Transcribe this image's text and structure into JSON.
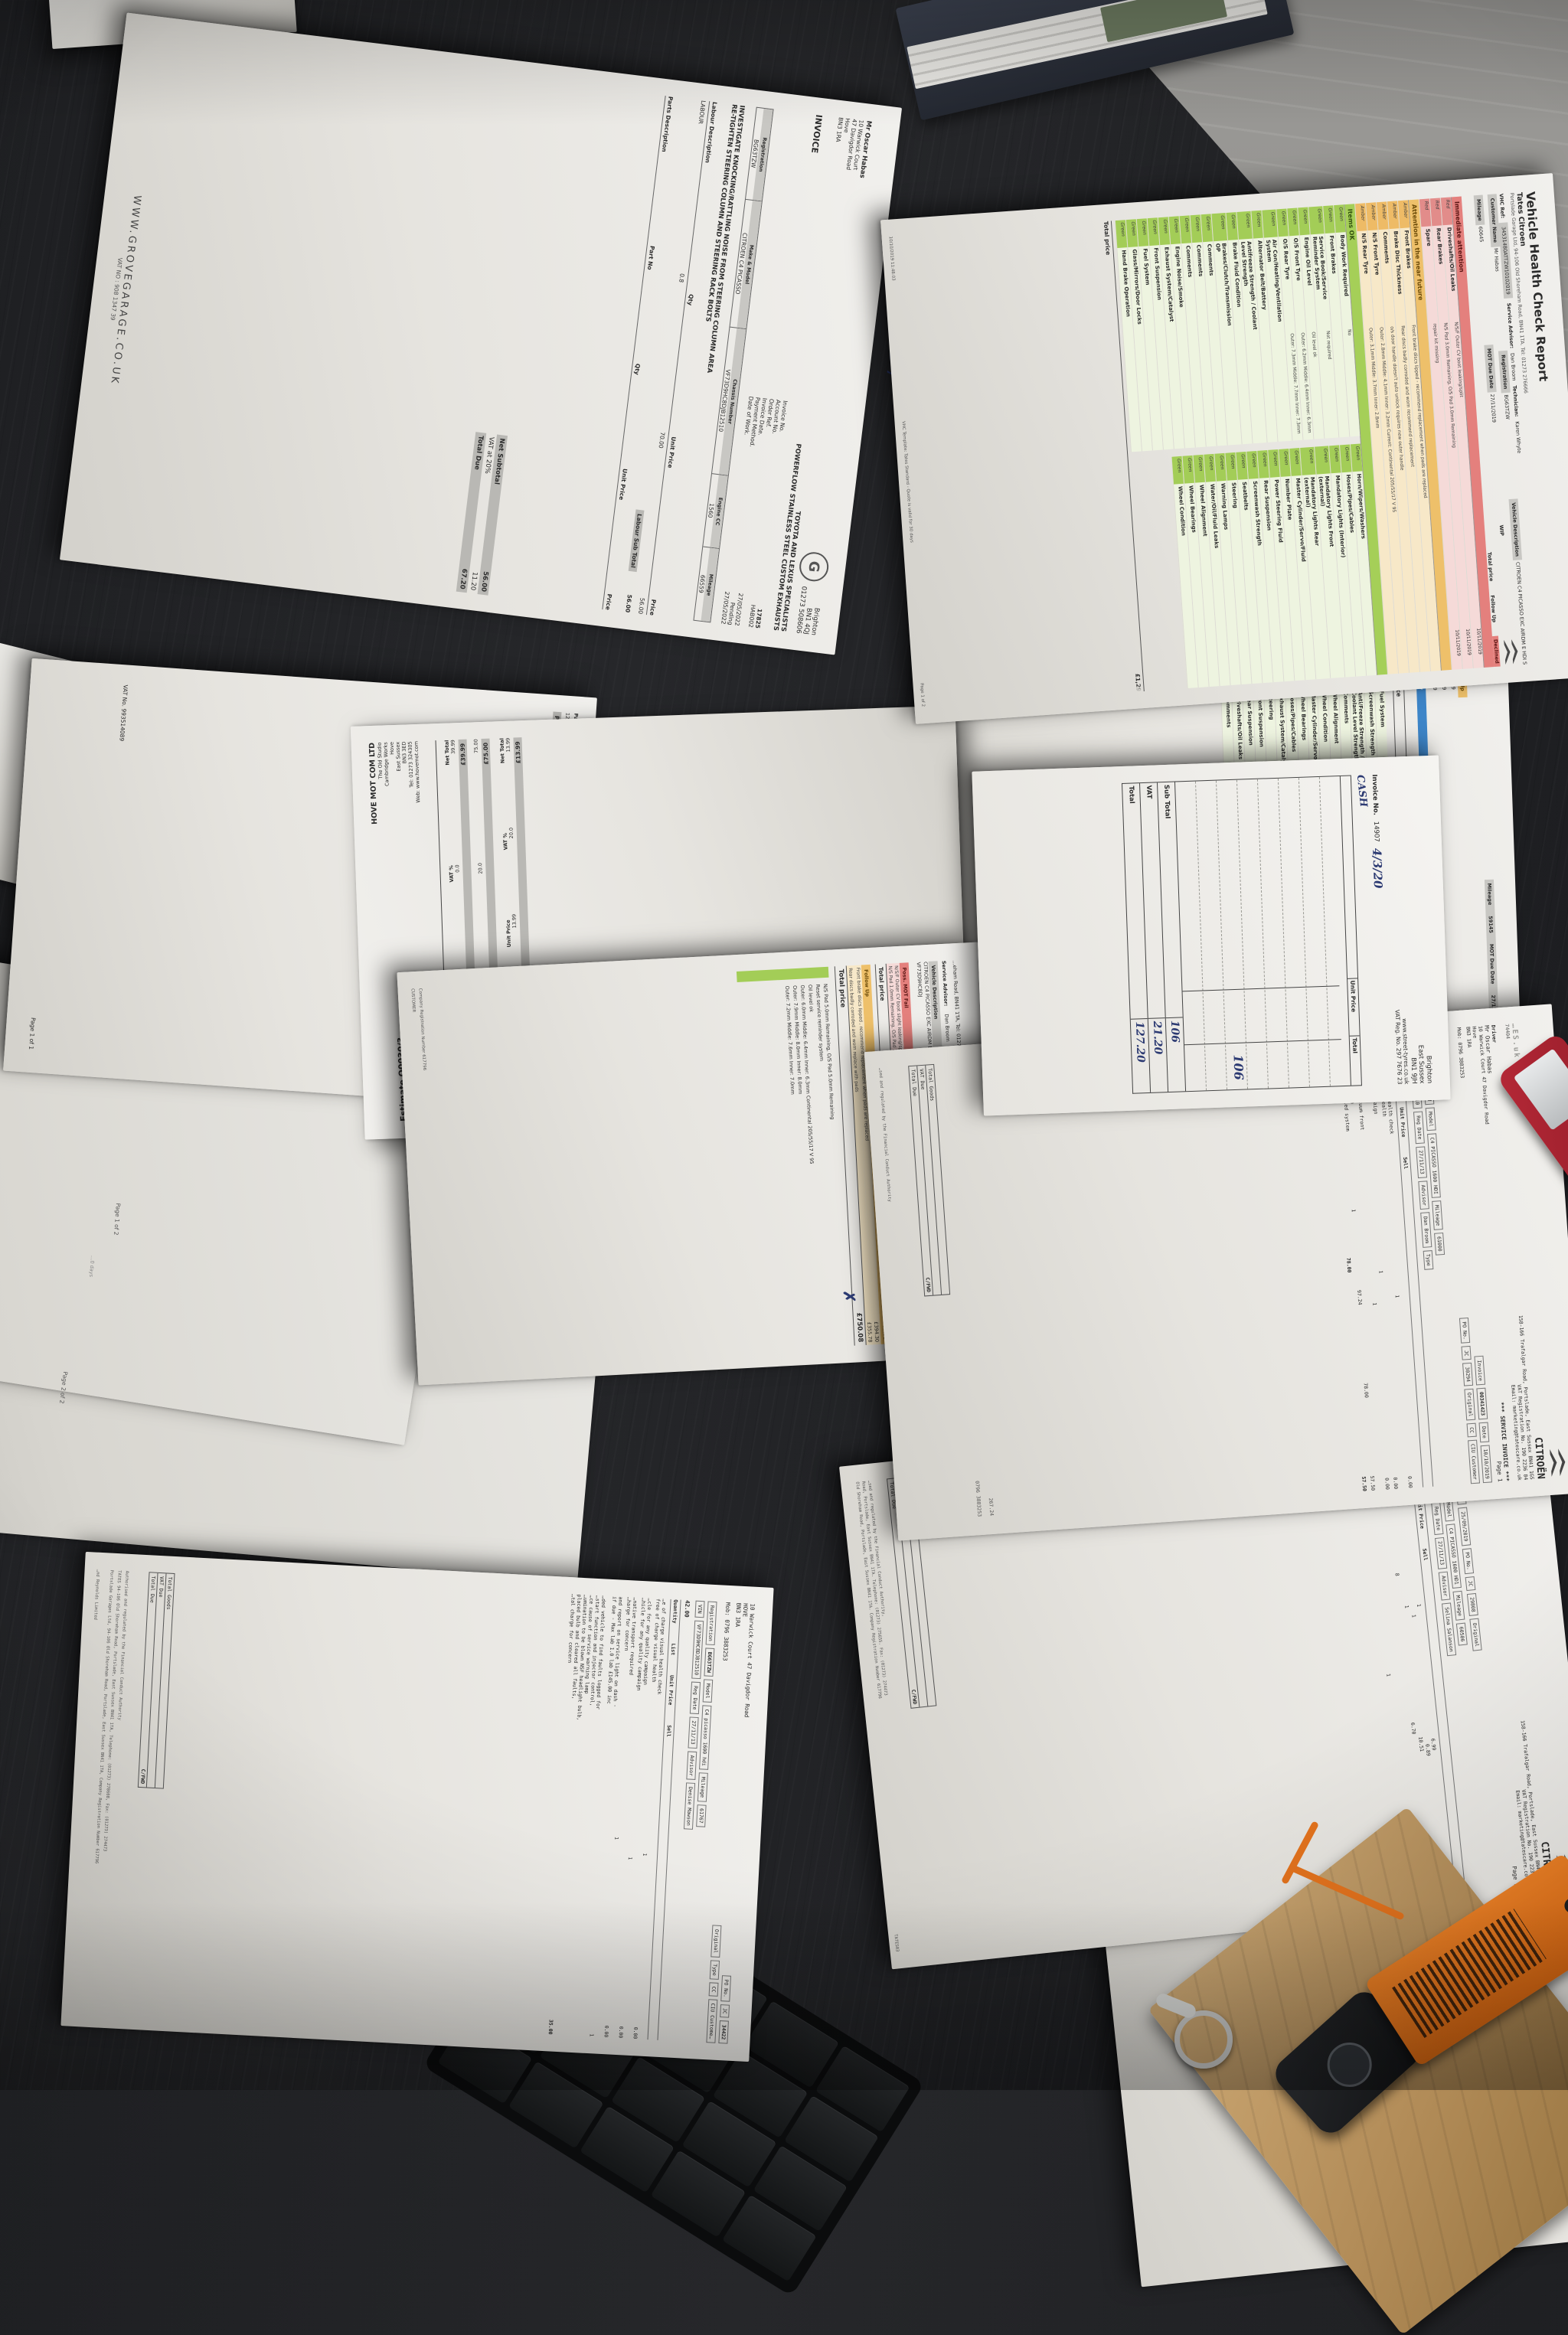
{
  "labels": {
    "red": "Red",
    "amber": "Amber",
    "green": "Green"
  },
  "misc": {
    "page1of2": "Page 1 of 2",
    "page2of2": "Page 2 of 2",
    "days": "…0 days",
    "hand_g": "G ⁊",
    "corner": "74404",
    "reynolds": "…nd Reynolds Limited"
  },
  "vhc1": {
    "title": "Vehicle Health Check Report",
    "dealer": "Tates Citroen",
    "dealer_address": "Portslade Garage Ltd, 94-106 Old Shoreham Road, BN41 1TA. Tel: 01273 276666",
    "vhc_ref_label": "VHC Ref:",
    "vhc_ref": "34531480ATTZW10102019",
    "customer_label": "Customer Name",
    "customer": "Mr Habas",
    "reg_label": "Registration",
    "reg": "BG63TZW",
    "advisor_label": "Service Advisor:",
    "advisor": "Dan Broom",
    "tech_label": "Technician:",
    "tech": "Karen Whyte",
    "vdesc_label": "Vehicle Description",
    "vdesc": "CITROEN C4 PICASSO EXC AIRDM E HDI S",
    "mileage_label": "Mileage",
    "mileage": "60645",
    "mot_label": "MOT Due Date",
    "mot": "27/11/2019",
    "wip": "WIP",
    "col_total": "Total price",
    "col_follow": "Follow Up",
    "col_declined": "Declined",
    "sec_red": "Immediate attention",
    "red_rows": [
      {
        "item": "Driveshafts/Oil Leaks",
        "note": "N/S/F Outer CV boot leaking/split",
        "date": "10/11/2019"
      },
      {
        "item": "Rear Brakes",
        "note": "N/S Pad 3.0mm Remaining, O/S Pad 3.0mm Remaining",
        "date": "10/11/2019"
      },
      {
        "item": "Spare",
        "note": "repair kit missing",
        "date": "10/11/2019"
      }
    ],
    "sec_amber": "Attention in the near future",
    "amber_rows": [
      {
        "item": "Front Brakes",
        "note": "Front brake discs lipped - recommend replacement when pads are replaced"
      },
      {
        "item": "Brake Disc Thickness",
        "note": "Rear discs badly corroded and worn recommend replacement"
      },
      {
        "item": "Comments",
        "note": "o/s door handle doesn't auto unlock requires new outer handle"
      },
      {
        "item": "N/S Front Tyre",
        "note": "Outer: 2.8mm Middle: 4.1mm Inner: 3.2mm  Current: Continental 205/55/17 V 95"
      },
      {
        "item": "N/S Rear Tyre",
        "note": "Outer: 3.1mm Middle: 3.7mm Inner: 2.8mm"
      }
    ],
    "sec_green": "Items OK",
    "green1": [
      "Body Work Required",
      "Front Brakes",
      "Service Book/Service Reminder System",
      "Engine Oil Level",
      "O/S Front Tyre",
      "O/S Rear Tyre",
      "Air Con/Heating/Ventilation System",
      "Alternator Belt/Battery",
      "Antifreeze Strength / Coolant Level Strength",
      "Brake Fluid Condition",
      "Brakes/Clutch/Transmission OP",
      "Comments",
      "Comments",
      "Comments",
      "Engine Noise/Smoke",
      "Exhaust System/Catalyst",
      "Front Suspension",
      "Fuel System",
      "Glass/Mirrors/Door Locks",
      "Hand Brake Operation"
    ],
    "green1n": [
      "No",
      "",
      "Not required",
      "Oil level ok",
      "Outer: 6.2mm Middle: 6.4mm Inner: 6.3mm",
      "Outer: 7.3mm Middle: 7.7mm Inner: 7.3mm",
      "",
      "",
      "",
      "",
      "",
      "",
      "",
      "",
      "",
      "",
      "",
      "",
      "",
      ""
    ],
    "green2": [
      "Horn/Wipers/Washers",
      "Hoses/Pipes/Cables",
      "Mandatory Lights (Interior)",
      "Mandatory Lights Front (external)",
      "Mandatory Lights Rear (external)",
      "Master Cylinder/Servo/Fluid",
      "Number Plate",
      "Power Steering Fluid",
      "Rear Suspension",
      "Screenwash Strength",
      "Seatbelts",
      "Steering",
      "Warning Lamps",
      "Water/Oil/Fluid Leaks",
      "Wheel Alignment",
      "Wheel Bearings",
      "Wheel Condition"
    ],
    "total_label": "Total price",
    "total": "£1,29",
    "foot_ts": "10/10/2019 11:48:03",
    "foot_tpl": "VHC Template: Tates Standard - Quote is valid for 30 days",
    "foot_page": "Page 1 of 2"
  },
  "vhc2": {
    "mileage_label": "Mileage",
    "mileage": "59145",
    "mot_label": "MOT Due Date",
    "mot": "27/11/2019",
    "wip": "WIP",
    "follow": "Follow Up",
    "price": "Price",
    "dates": [
      "20/07/2019",
      "20/07/2019",
      "20/07/2019"
    ],
    "prices": [
      "£263.01",
      "£477.43",
      "£157.61"
    ],
    "warranty": "Warranty",
    "completed": "Completed",
    "no1": "No",
    "no2": "No",
    "total_label": "Total price",
    "total": "£1,173.86",
    "green": [
      "Fuel System",
      "Screenwash Strength",
      "Anti/Freeze Strength / Coolant Level Strength",
      "Comments",
      "Wheel Alignment",
      "Wheel Condition",
      "Master Cylinder/Servo/Fluid",
      "Wheel Bearings",
      "Hoses/Pipes/Cables",
      "Exhaust System/Catalyst",
      "Steering",
      "Front Suspension",
      "Rear Suspension",
      "Driveshafts/Oil Leaks",
      "Comments"
    ],
    "greenn": [
      "",
      "",
      "",
      "6mm",
      "",
      "4.3mm",
      "",
      "",
      "",
      "",
      "",
      "",
      "",
      "",
      ""
    ]
  },
  "vhc3": {
    "addr": "…eham Road, BN41 1TA, Tel: 01273 276666",
    "advisor_label": "Service Advisor:",
    "advisor": "Dan Broom",
    "tech_label": "Technician:",
    "tech": "Sean Fullman",
    "vdesc_label": "Vehicle Description",
    "vdesc": "CITROEN C4 PICASSO EXC AIRDM E-HDI S",
    "mileage_label": "Mileage",
    "mileage": "63181",
    "mot_label": "MOT Due Date",
    "mot": "06/12/2020",
    "wip": "WIP",
    "vin": "VF73D9HC8DJ",
    "vin2": "812510BG63T",
    "vin3": "ZW011220",
    "brand": "CITROËN",
    "redh1": "Poss. MOT",
    "redh2": "Fail",
    "redh3": "Declined",
    "redh4": "Price",
    "red_note1": "N/S/F Outer CV boot slight leaking/split",
    "red_note2": "N/S Pad 1.0mm Remaining, O/S Pad 2.0mm Remaining - see amber section for pricing",
    "red_yes": "Yes",
    "red_price": "£269.27",
    "tp_label": "Total price",
    "tp1": "£269.27",
    "follow": "Follow Up",
    "price": "Price",
    "amber1": "Front brake discs lipped , recommend replacement when pads are replaced",
    "amber1_price": "£394.30",
    "amber2": "Rear discs badly corroded and worn replace with pads",
    "amber2_price": "£355.78",
    "total2_label": "Total price",
    "total2": "£750.08",
    "notes": [
      "N/S Pad 5.0mm Remaining, O/S Pad 5.0mm Remaining",
      "Reset service reminder system",
      "Oil level ok",
      "Outer: 6.0mm Middle: 6.4mm Inner: 6.3mm  Continental 205/55/17 V 95",
      "Outer: 7.9mm Middle: 8.0mm Inner: 8.0mm",
      "Outer: 7.2mm Middle: 7.6mm Inner: 7.0mm"
    ],
    "side1": "Company Registration Number 617796",
    "side2": "CUSTOMER",
    "side3": "TATES03"
  },
  "street": {
    "city": "Brighton",
    "county": "East Sussex",
    "pc": "BN1 9JH",
    "web": "www.street-tyres.co.uk",
    "vat": "VAT Reg. No. 297 7676 23",
    "inv_label": "Invoice No.",
    "inv": "14907",
    "hw_date": "4/3/20",
    "hw_cash": "CASH",
    "col_unit": "Unit Price",
    "col_total": "Total",
    "hw_amount": "106",
    "sub_label": "Sub Total",
    "sub": "106",
    "vat_label": "VAT",
    "vat_val": "21.20",
    "total_label": "Total",
    "total_val": "127.20"
  },
  "hove1": {
    "name": "HOVE MOT COM LTD",
    "addr": [
      "The Old Studio",
      "Cambridge Works",
      "Hove",
      "East Sussex",
      "BN3 3ED",
      "Tel: 01273 324305",
      "Web: www.hovemot.com"
    ],
    "title": "Estimate Q0030/3",
    "date": "Date: 08-12-2020 09:16 AM",
    "vin_label": "VIN:",
    "vin": "VF73D9HC8DJ812510",
    "mil_label": "Mileage:",
    "lc1": "Hrs",
    "lc2": "Unit Price",
    "lc3": "VAT %",
    "lc4": "Net Total",
    "l1": {
      "hrs": "1.00",
      "unit": "39.99",
      "vat": "0.0",
      "net": "39.99"
    },
    "lst1": "Labour SubTotal",
    "lst1v": "£39.99",
    "l2": {
      "hrs": "1.50",
      "unit": "50.00",
      "vat": "20.0",
      "net": "75.00"
    },
    "lst2": "Labour SubTotal",
    "lst2v": "£75.00",
    "pc1": "Part No",
    "pc2": "Qty",
    "pc3": "Unit Price",
    "pc4": "VAT %",
    "pc5": "Net Total",
    "p1": {
      "no": "12/8/7/877",
      "qty": "1.00",
      "unit": "13.99",
      "vat": "20.0",
      "net": "13.99"
    },
    "pst1": "Parts SubTotal",
    "pst1v": "£13.99"
  },
  "hove2": {
    "pc1": "Part No",
    "pc2": "Qty",
    "pc3": "Unit Price",
    "pc4": "VAT %",
    "pc5": "Net Total",
    "p": {
      "no": "12/88/7/9",
      "qty": "1.00",
      "unit": "45.99",
      "vat": "20.0",
      "net": "45.99"
    },
    "pst": "Parts SubTotal",
    "pstv": "£45.99",
    "s1": "Labour",
    "s1v": "114.99",
    "s2": "Parts",
    "s2v": "59.98",
    "s3": "VAT",
    "s3v": "27.00",
    "total_label": "Estimate Total",
    "total": "£201.97",
    "vatno": "VAT No. 993514089",
    "page": "Page 1 of 1"
  },
  "grove": {
    "customer": "Mr Oscar Habas",
    "c1": "10 Warwick Court",
    "c2": "47 Davigdor Road",
    "c3": "Hove",
    "c4": "BN3 1RA",
    "logo": "G",
    "city": "Brighton",
    "pc": "BN1 4QJ",
    "tel": "01273 508606",
    "tag1": "TOYOTA AND LEXUS SPECIALISTS",
    "tag2": "POWERFLOW STAINLESS STEEL CUSTOM EXHAUSTS",
    "inv_title": "INVOICE",
    "f1": "Invoice No.",
    "v1": "17825",
    "f2": "Account No.",
    "v2": "HAB002",
    "f3": "Order Ref.",
    "v3": "",
    "f4": "Invoice Date.",
    "v4": "27/05/2022",
    "f5": "Payment Method.",
    "v5": "Pending",
    "f6": "Date of Work.",
    "v6": "27/05/2022",
    "vc1": "Registration",
    "vv1": "BG63TZW",
    "vc2": "Make & Model",
    "vv2": "CITROEN C4 PICASSO",
    "vc3": "Chassis Number",
    "vv3": "VF73D9HC8DJB12510",
    "vc4": "Engine CC",
    "vv4": "1560",
    "vc5": "Mileage",
    "vv5": "66559",
    "job1": "INVESTIGATE KNOCKING/RATTLING NOISE FROM STEERING COLUMN AREA",
    "job2": "RE-TIGHTEN STEERING COLUMN AND STEERING RACK BOLTS",
    "lh1": "Labour Description",
    "lh2": "Qty",
    "lh3": "Unit Price",
    "lh4": "Price",
    "lr1": "LABOUR",
    "lr2": "0.8",
    "lr3": "70.00",
    "lr4": "56.00",
    "lsub": "Labour Sub Total",
    "lsubv": "56.00",
    "ph1": "Parts Description",
    "ph2": "Part No",
    "ph3": "Qty",
    "ph4": "Unit Price",
    "ph5": "Price",
    "t1": "Net Subtotal",
    "t1v": "56.00",
    "t2": "VAT at 20%",
    "t2v": "11.20",
    "t3": "Total Due",
    "t3v": "67.20",
    "web": "WWW.GROVEGARAGE.CO.UK",
    "vatno": "VAT NO : 908 1347 39"
  },
  "cit1": {
    "brand": "CITROËN",
    "corp": "…ES",
    "uk": ".uk",
    "a1": "158-166 Trafalgar Road, Portslade, East Sussex BN41 1GS",
    "a2": "VAT Registration No. 190 2236 84",
    "a3": "Email: marketing@tatescare.co.uk",
    "title": "*** SERVICE INVOICE ***",
    "page_label": "Page",
    "page": "1",
    "driver_label": "Driver",
    "driver": "Mr Oscar Habas",
    "da1": "10 Warwick Court 47 Davigdor Road",
    "da2": "Hove",
    "da3": "BN3 1RA",
    "mob": "Mob: 0796 3883253",
    "f1": "Invoice",
    "v1": "00341423",
    "f2": "Date",
    "v2": "10/10/2019",
    "f3": "PO No.",
    "v3": "",
    "f4": "JC",
    "v4": "30294",
    "orig": "Original",
    "cc": "CC",
    "ciu": "CIU Customer",
    "rl": "Registration",
    "rv": "BG63TZW",
    "ml": "Model",
    "mv": "C4 PICASSO 1600 HDI",
    "mil": "Mileage",
    "milv": "61000",
    "vl": "VIN",
    "vv": "VF73D9HC8DJB12510",
    "rdl": "Reg Date",
    "rdv": "27/11/13",
    "al": "Advisor",
    "av": "Dan Broom",
    "tl": "Type",
    "c1": "Quantity",
    "c2": "List",
    "c3": "Unit Price",
    "c4": "Sell",
    "amt": "167.50",
    "i1a": "free of charge visual health check",
    "i1b": "free of charge visual health",
    "i1q": "1",
    "i1s": "0.00",
    "i2a": "…e for any quality campaign",
    "i2b": "for concern",
    "i2q": "1",
    "i2s": "0.00",
    "i3a": "…limentary wash and vacuum front",
    "i3q": "1",
    "i3s": "0.00",
    "i4a": "…lter housing - £185.69",
    "i4b": "OK, filter housing - bled system",
    "i4q": "1",
    "i4l": "97.24",
    "i4u": "78.00",
    "i4s": "57.50",
    "x1": "135.50",
    "x2": "78.00",
    "x3": "57.50",
    "tg": "Total Goods",
    "vd": "VAT Due",
    "td": "Total Due",
    "cfwd": "C/FWD",
    "side1": "267.24",
    "side2": "0796 3883253",
    "foot": "…sed and regulated by the Financial Conduct Authority"
  },
  "cit2": {
    "brand": "CITROËN",
    "a1": "158-166 Trafalgar Road, Portslade, East Sussex BN41 1GS",
    "a2": "VAT Registration No. 190 2236 84",
    "a3": "Email: marketing@tatescare.co.uk",
    "title": "*** SERVICE INVOICE ***",
    "page_label": "Page",
    "page": "1",
    "driver": "…car Habas",
    "da1": "…wick Court 47 Davigdor Road",
    "da2": "…RA",
    "mob": "0796 3883253",
    "f1": "Invoice",
    "v1": "00340666",
    "f2": "Date",
    "v2": "25/09/2019",
    "f3": "PO No.",
    "v3": "",
    "f4": "JC",
    "v4": "29808",
    "orig": "Original",
    "cc": "CC",
    "ciu": "CIU Customer",
    "rl": "Registration",
    "rv": "BG63TZW",
    "ml": "Model",
    "mv": "C4 PICASSO 1600 HD1",
    "mil": "Mileage",
    "milv": "60506",
    "vl": "VIN",
    "vv": "VF73D9HC8DJB12510",
    "rdl": "Reg Date",
    "rdv": "27/11/13",
    "al": "Advisor",
    "av": "Selina Salanson",
    "c1": "Quantity",
    "c2": "List",
    "c3": "Unit Price",
    "c4": "Sell",
    "i1a": "…RVICE - £299.00",
    "i1q": "1",
    "i1l": "6.99",
    "i1s": "6.99",
    "i2a": "…RVICE - cost amended",
    "i2q": "1",
    "i2l": "0.89",
    "i2s": "0.89",
    "i3a": "…filter (requires",
    "i3q": "1",
    "i3l": "10.51",
    "i3s": "10.51",
    "i4q": "8",
    "i4l": "6.70",
    "i4s": "53.60",
    "x1": "135.21",
    "x2": "222.70",
    "i5a": "…URTESY CAR",
    "i5b": "COURTESY CAR",
    "i5q": "1",
    "i5s": "0.00",
    "i6a": "…ge visual health check",
    "i6b": "…arge visual health",
    "i6q": "1",
    "i6s": "0.00",
    "i7a": "…quality campaign",
    "i7q": "1",
    "tg": "Total Goods",
    "vd": "VAT Due",
    "td": "Total Due",
    "cfwd": "C/FWD",
    "foot1": "…sed and regulated by the Financial Conduct Authority,",
    "foot2": "Road, Portslade, East Sussex BN41 1TA. Telephone: (01273) 275655. Fax: (01273) 274473",
    "foot3": "Old Shoreham Road, Portslade, East Sussex BN41 1TA. Company Registration Number 617796",
    "tag": "TATES03"
  },
  "cit3": {
    "brand": "CITROËN",
    "a1": "…Trafalgar Road, Portslade, East Sussex BN41 1GS",
    "a2": "VAT Registration No. 190 2236 84",
    "a3": "Email: marketing@tatescare.co.uk",
    "title": "*** SERVICE INVOICE ***",
    "page_label": "Page",
    "page": "1",
    "f1": "Invoice",
    "v1": "00336631",
    "f2": "Date",
    "v2": "20/06/2019",
    "f3": "PO No.",
    "v3": "",
    "f4": "JC",
    "v4": "27063",
    "orig": "Original",
    "cc": "CC",
    "ciu": "CIU C…",
    "rl": "…ration",
    "rv": "…TZW",
    "ml": "Model",
    "mv": "C4 Picasso 1600 hd1",
    "ms": "M…",
    "vl": "N",
    "vv": "D3812510",
    "rdl": "Reg Date",
    "rdv": "27/11/13",
    "al": "Advisor",
    "av": "Selina Sala…",
    "c1": "Quantity",
    "c2": "List",
    "c3": "Unit Price",
    "da": "…gdor Road"
  },
  "cit4": {
    "da1": "10 Warwick Court 47 Davigdor Road",
    "da2": "HOVE",
    "da3": "BN3 1RA",
    "mob": "Mob:  0796 3883253",
    "f1": "PO No.",
    "f2": "JC",
    "v2": "34422",
    "orig": "Original",
    "type": "Type",
    "cc": "CC",
    "ciu": "CIU Custome…",
    "rl": "Registration",
    "rv": "BG63TZW",
    "ml": "Model",
    "mv": "C4 picasso 1600 hdi",
    "mil": "Mileage",
    "milv": "61767",
    "vl": "VIN",
    "vv": "VF73D9HC8DJB12510",
    "rdl": "Reg Date",
    "rdv": "27/11/13",
    "al": "Advisor",
    "av": "Denise Mawson",
    "amt": "42.00",
    "corner": "…3.35",
    "hove": "HOVE",
    "pc": "BN3 1RA",
    "c1": "Quantity",
    "c2": "List",
    "c3": "Unit Price",
    "c4": "Sell",
    "i1a": "…e of charge visual health check",
    "i1b": "free of charge visual health",
    "i1q": "1",
    "i1v": "0.00",
    "i2a": "…cle for any quality campaign",
    "i2b": "…hicle for any quality campaign",
    "i2q": "1",
    "i2v": "0.00",
    "i3a": "…native transport required",
    "i3b": "…harge for concern",
    "i3q": "1",
    "i3v": "0.00",
    "i4a": "and report on service light on dash -",
    "i4b": "if due -  Max lab 1.0 lab £145.00 inc",
    "i4q": "1",
    "n1": "…ded vehicle to find faults logged for",
    "n2": "…start function and injector control,",
    "n3": "…ce cause of service warning lamp",
    "n4": "…umination to be blown NSF headlight bulb,",
    "n5": "placed bulb and cleared all faults,",
    "n6": "…tal charge for concern",
    "n6v": "35.00",
    "tg": "Total Goods",
    "vd": "VAT Due",
    "td": "Total Due",
    "cfwd": "C/FWD",
    "foot1": "Authorised and regulated by the Financial Conduct Authority",
    "foot2": "TATES 94-106 Old Shoreham Road, Portslade, East Sussex BN41 1TA, Telephone: (01273) 278608, Fax: (01273) 274473",
    "foot3": "Portslade Garages Ltd, 94-106 Old Shoreham Road, Portslade, East Sussex BN41 1TA, Company Registration Number 617796"
  }
}
